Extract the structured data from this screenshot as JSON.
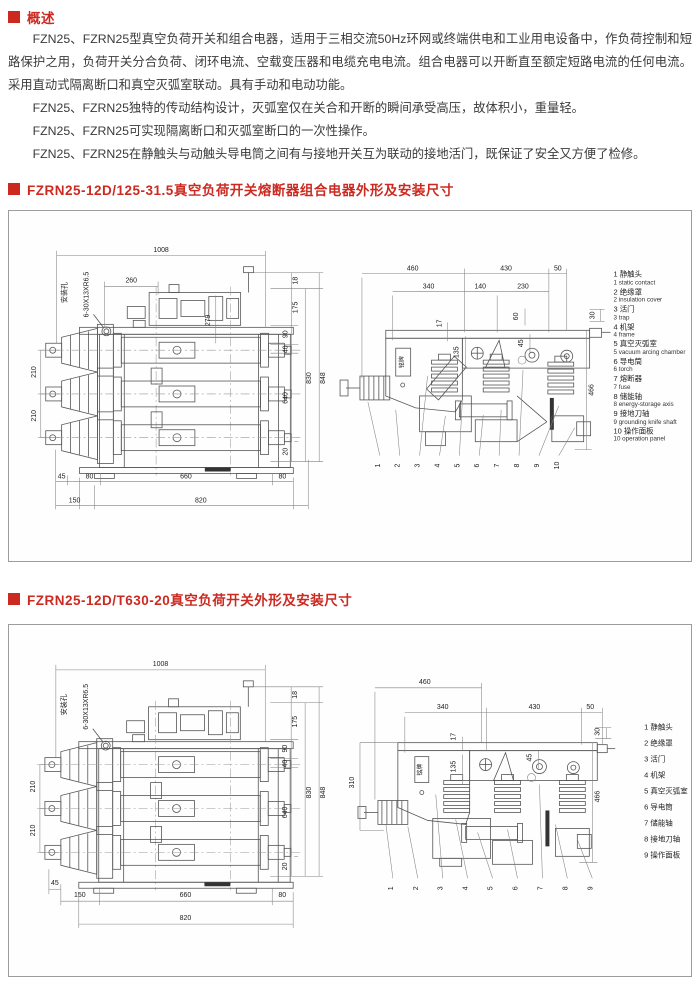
{
  "colors": {
    "accent": "#cc2a21",
    "body_text": "#3a3a3a"
  },
  "overview": {
    "header": "概述",
    "paragraphs": [
      "FZN25、FZRN25型真空负荷开关和组合电器，适用于三相交流50Hz环网或终端供电和工业用电设备中，作负荷控制和短路保护之用，负荷开关分合负荷、闭环电流、空载变压器和电缆充电电流。组合电器可以开断直至额定短路电流的任何电流。采用直动式隔离断口和真空灭弧室联动。具有手动和电动功能。",
      "FZN25、FZRN25独特的传动结构设计，灭弧室仅在关合和开断的瞬间承受高压，故体积小，重量轻。",
      "FZN25、FZRN25可实现隔离断口和灭弧室断口的一次性操作。",
      "FZN25、FZRN25在静触头与动触头导电筒之间有与接地开关互为联动的接地活门，既保证了安全又方便了检修。"
    ]
  },
  "sections": [
    {
      "title": "FZRN25-12D/125-31.5真空负荷开关熔断器组合电器外形及安装尺寸",
      "front": {
        "w1008": "1008",
        "hole_label": "安装孔",
        "hole_spec": "6-30X13XR6.5",
        "d260": "260",
        "d279": "279",
        "l210a": "210",
        "l210b": "210",
        "r18": "18",
        "r175": "175",
        "r90": "90",
        "r40": "40",
        "r640": "640",
        "r20": "20",
        "r830": "830",
        "r848": "848",
        "b45": "45",
        "b80l": "80",
        "b660": "660",
        "b80r": "80",
        "b150": "150",
        "b820": "820"
      },
      "side": {
        "t460": "460",
        "t430": "430",
        "t50": "50",
        "t340": "340",
        "t140": "140",
        "t230": "230",
        "v17": "17",
        "v135": "135",
        "v60": "60",
        "v45": "45",
        "v30": "30",
        "r466": "466",
        "nameplate": "铭牌"
      },
      "legend": [
        {
          "zh": "1 静触头",
          "en": "1 static contact"
        },
        {
          "zh": "2 绝缘罩",
          "en": "2 insulation cover"
        },
        {
          "zh": "3 活门",
          "en": "3 trap"
        },
        {
          "zh": "4 机架",
          "en": "4 frame"
        },
        {
          "zh": "5 真空灭弧室",
          "en": "5 vacuum arcing chamber"
        },
        {
          "zh": "6 导电筒",
          "en": "6 torch"
        },
        {
          "zh": "7 熔断器",
          "en": "7 fuse"
        },
        {
          "zh": "8 储能轴",
          "en": "8 energy-storage axis"
        },
        {
          "zh": "9 接地刀轴",
          "en": "9 grounding knife shaft"
        },
        {
          "zh": "10 操作面板",
          "en": "10 operation panel"
        }
      ],
      "callouts": [
        "1",
        "2",
        "3",
        "4",
        "5",
        "6",
        "7",
        "8",
        "9",
        "10"
      ]
    },
    {
      "title": "FZRN25-12D/T630-20真空负荷开关外形及安装尺寸",
      "front": {
        "w1008": "1008",
        "hole_label": "安装孔",
        "hole_spec": "6-30X13XR6.5",
        "l210a": "210",
        "l210b": "210",
        "r18": "18",
        "r175": "175",
        "r90": "90",
        "r40": "40",
        "r640": "640",
        "r20": "20",
        "r830": "830",
        "r848": "848",
        "b45": "45",
        "b150": "150",
        "b660": "660",
        "b80": "80",
        "b820": "820"
      },
      "side": {
        "t460": "460",
        "t340": "340",
        "t430": "430",
        "t50": "50",
        "v17": "17",
        "v135": "135",
        "v45": "45",
        "v30": "30",
        "l310": "310",
        "r466": "466",
        "nameplate": "铭牌"
      },
      "legend": [
        {
          "zh": "1 静触头"
        },
        {
          "zh": "2 绝缘罩"
        },
        {
          "zh": "3 活门"
        },
        {
          "zh": "4 机架"
        },
        {
          "zh": "5 真空灭弧室"
        },
        {
          "zh": "6 导电筒"
        },
        {
          "zh": "7 储能轴"
        },
        {
          "zh": "8 接地刀轴"
        },
        {
          "zh": "9 操作面板"
        }
      ],
      "callouts": [
        "1",
        "2",
        "3",
        "4",
        "5",
        "6",
        "7",
        "8",
        "9"
      ]
    }
  ]
}
